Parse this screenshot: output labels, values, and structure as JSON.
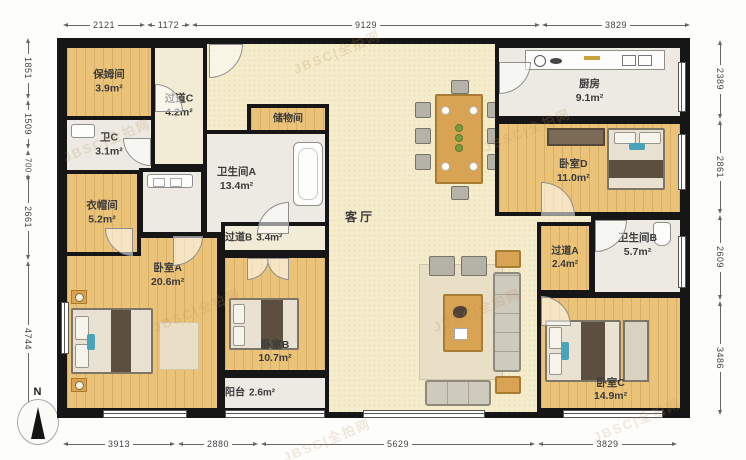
{
  "compass_label": "N",
  "watermark": "JBSC|全拍网",
  "rooms": {
    "nanny": {
      "name": "保姆间",
      "area": "3.9m²"
    },
    "hall_c": {
      "name": "过道C",
      "area": "4.2m²"
    },
    "bath_c": {
      "name": "卫C",
      "area": "3.1m²"
    },
    "storage": {
      "name": "储物间"
    },
    "bath_a": {
      "name": "卫生间A",
      "area": "13.4m²"
    },
    "cloak": {
      "name": "衣帽间",
      "area": "5.2m²"
    },
    "bedroom_a": {
      "name": "卧室A",
      "area": "20.6m²"
    },
    "hall_b": {
      "name": "过道B",
      "area": "3.4m²"
    },
    "bedroom_b": {
      "name": "卧室B",
      "area": "10.7m²"
    },
    "balcony": {
      "name": "阳台",
      "area": "2.6m²"
    },
    "living": {
      "name": "客厅"
    },
    "kitchen": {
      "name": "厨房",
      "area": "9.1m²"
    },
    "bedroom_d": {
      "name": "卧室D",
      "area": "11.0m²"
    },
    "hall_a": {
      "name": "过道A",
      "area": "2.4m²"
    },
    "bath_b": {
      "name": "卫生间B",
      "area": "5.7m²"
    },
    "bedroom_c": {
      "name": "卧室C",
      "area": "14.9m²"
    }
  },
  "dimensions": {
    "top": [
      "2121",
      "1172",
      "9129",
      "3829"
    ],
    "bottom": [
      "3913",
      "2880",
      "5629",
      "3829"
    ],
    "left": [
      "1851",
      "1509",
      "700",
      "2661",
      "4744"
    ],
    "right": [
      "2389",
      "2861",
      "2609",
      "3486"
    ]
  },
  "colors": {
    "wall": "#161616",
    "wood_floor": "#eac379",
    "living_floor": "#f4ecca",
    "tile_floor": "#eceae3",
    "furniture_accent": "#d8a352"
  }
}
